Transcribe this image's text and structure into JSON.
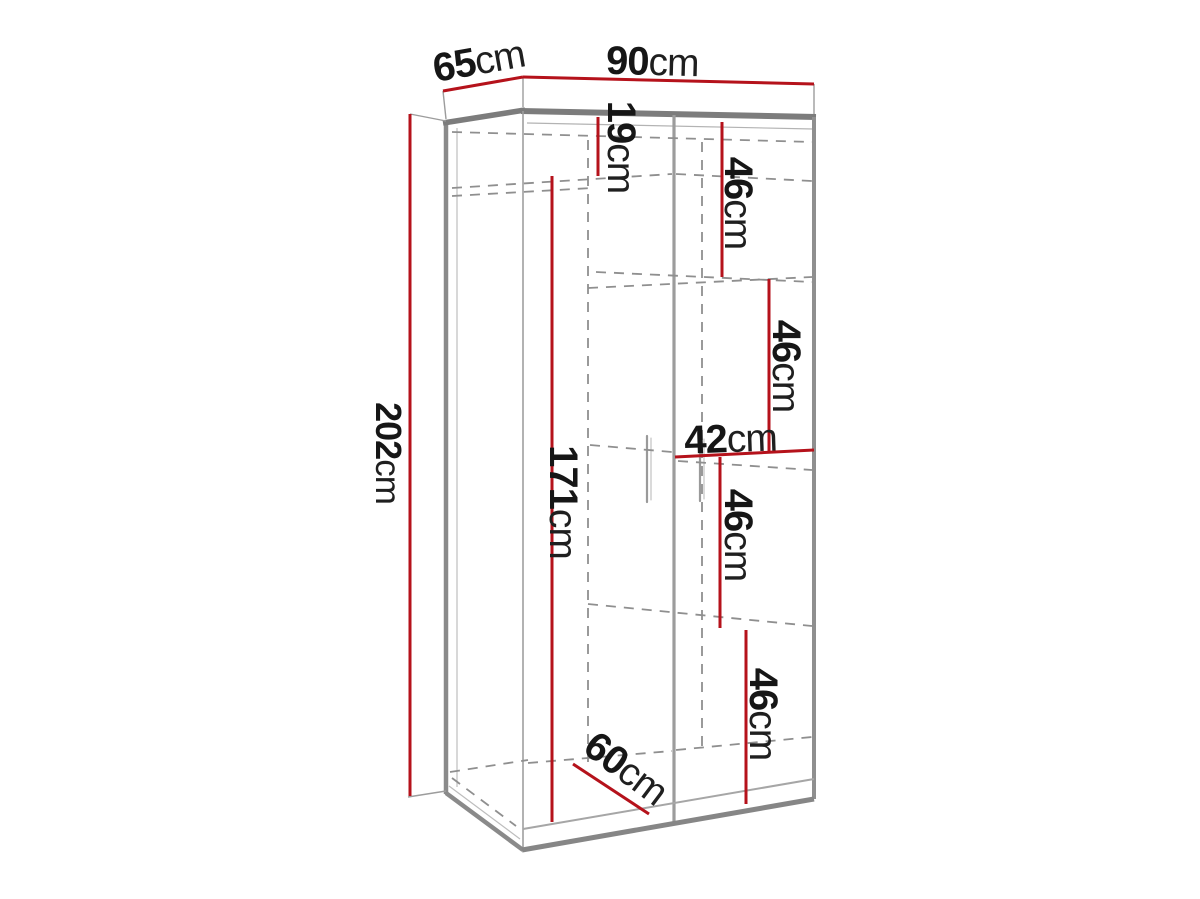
{
  "diagram": {
    "background": "#ffffff",
    "line_colors": {
      "dimension_red": "#b5121b",
      "outline_gray": "#8a8a8a",
      "outline_dark": "#7c7c7c",
      "hidden_dashed_gray": "#8f8f8f",
      "label_text": "#161616"
    },
    "measurements": [
      {
        "name": "top-depth",
        "value": "65",
        "unit": "cm"
      },
      {
        "name": "top-width",
        "value": "90",
        "unit": "cm"
      },
      {
        "name": "total-height",
        "value": "202",
        "unit": "cm"
      },
      {
        "name": "top-section-height",
        "value": "19",
        "unit": "cm"
      },
      {
        "name": "shelf-section-1",
        "value": "46",
        "unit": "cm"
      },
      {
        "name": "shelf-section-2",
        "value": "46",
        "unit": "cm"
      },
      {
        "name": "shelf-column-width",
        "value": "42",
        "unit": "cm"
      },
      {
        "name": "shelf-section-3",
        "value": "46",
        "unit": "cm"
      },
      {
        "name": "shelf-section-4",
        "value": "46",
        "unit": "cm"
      },
      {
        "name": "hanging-section-height",
        "value": "171",
        "unit": "cm"
      },
      {
        "name": "internal-depth",
        "value": "60",
        "unit": "cm"
      }
    ]
  }
}
